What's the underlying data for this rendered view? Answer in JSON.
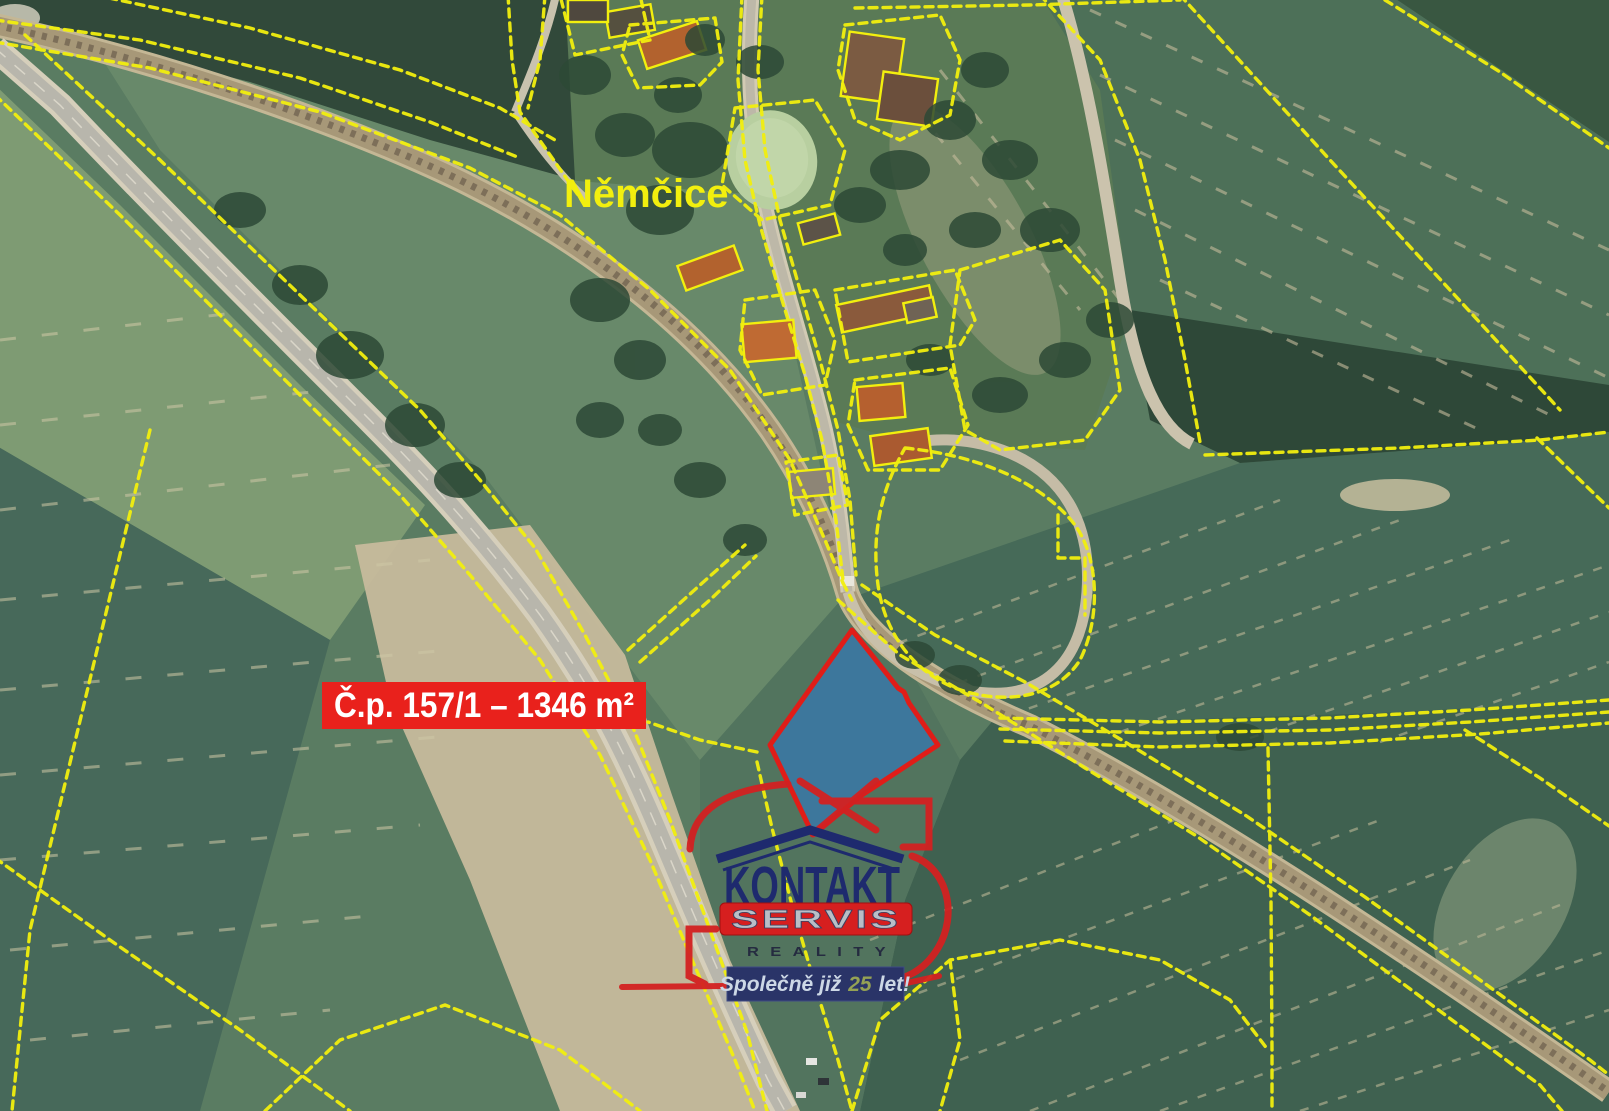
{
  "labels": {
    "place": "Němčice",
    "parcel": "Č.p. 157/1 – 1346 m²"
  },
  "logo": {
    "kontakt": "KONTAKT",
    "servis": "SERVIS",
    "reality": "REALITY",
    "slogan_pre": "Společně již",
    "slogan_num": "25",
    "slogan_post": "let!"
  },
  "colors": {
    "cadastral": "#f2ef0e",
    "parcel_fill": "#3877aa",
    "parcel_stroke": "#e01d18",
    "label_bg": "#e9211c",
    "label_text": "#ffffff",
    "place_text": "#f2ef0e",
    "logo_red": "#d32121",
    "logo_navy": "#1e2a6e",
    "servis_box": "#d61f1f",
    "servis_text": "#b9bec6",
    "reality_text": "#252b40",
    "banner_bg": "#2a3468",
    "banner_text": "#cdd8e6",
    "banner_number": "#95a254"
  }
}
